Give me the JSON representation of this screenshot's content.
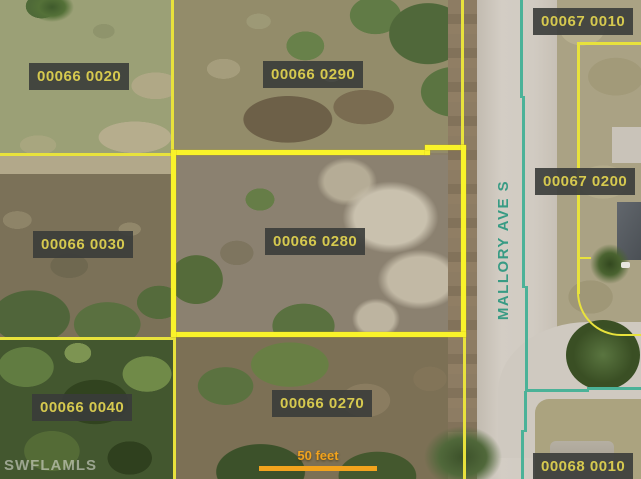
{
  "watermark": "SWFLAMLS",
  "street": {
    "name": "MALLORY AVE S"
  },
  "scale": {
    "label": "50 feet"
  },
  "parcels": {
    "p00066_0020": {
      "label": "00066 0020"
    },
    "p00066_0290": {
      "label": "00066 0290"
    },
    "p00067_0010": {
      "label": "00067 0010"
    },
    "p00067_0200": {
      "label": "00067 0200"
    },
    "p00066_0030": {
      "label": "00066 0030"
    },
    "p00066_0280": {
      "label": "00066 0280"
    },
    "p00066_0040": {
      "label": "00066 0040"
    },
    "p00066_0270": {
      "label": "00066 0270"
    },
    "p00068_0010": {
      "label": "00068 0010"
    }
  },
  "colors": {
    "parcel_line": "#e8e23c",
    "selected_parcel_line": "#f9f32a",
    "right_of_way_line": "#4bb298",
    "label_text": "#d6c94f",
    "label_background": "#3a3c3a",
    "street_text": "#389b84",
    "scale_bar": "#f2a31d"
  }
}
